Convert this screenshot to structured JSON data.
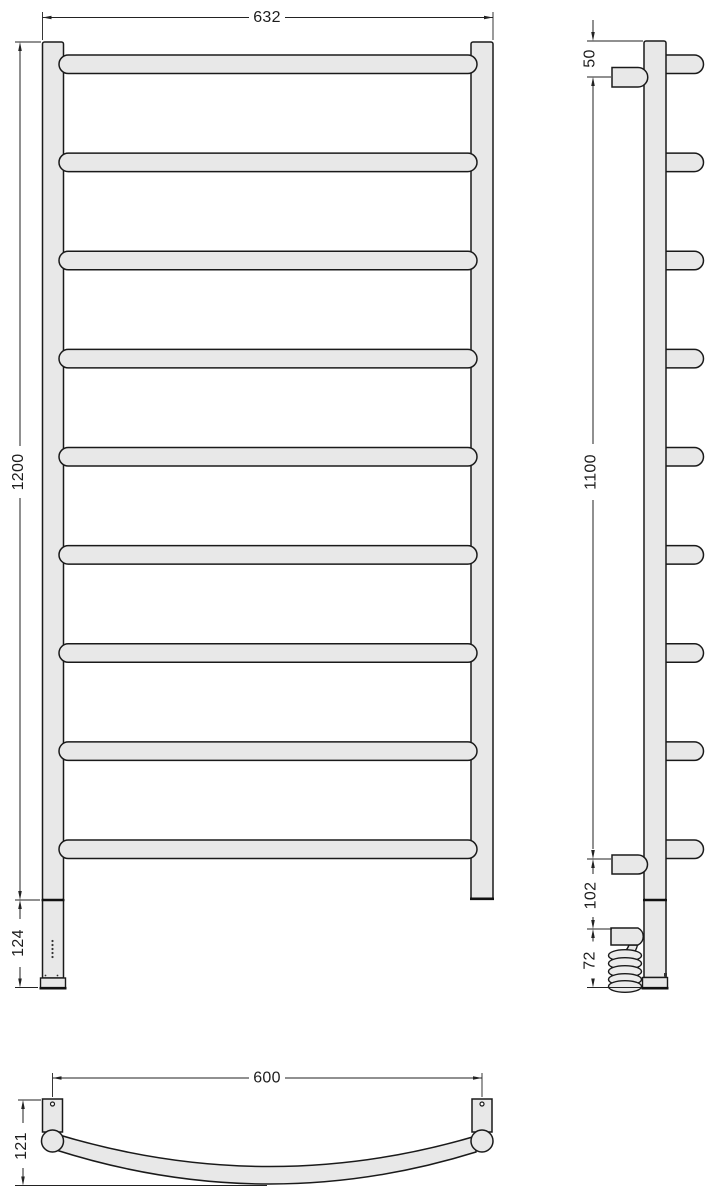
{
  "drawing_type": "technical-drawing-towel-rail",
  "views": {
    "front": {
      "label": "front-view",
      "bar_count": 9,
      "dimensions": {
        "width": {
          "value": "632"
        },
        "height": {
          "value": "1200"
        },
        "heater_section": {
          "value": "124"
        }
      }
    },
    "side": {
      "label": "side-view",
      "bar_count": 9,
      "bracket_count": 2,
      "dimensions": {
        "top_offset": {
          "value": "50"
        },
        "bracket_span": {
          "value": "1100"
        },
        "connection_offset": {
          "value": "102"
        },
        "cable_drop": {
          "value": "72"
        }
      }
    },
    "bottom": {
      "label": "bottom-view",
      "dimensions": {
        "rail_width": {
          "value": "600"
        },
        "depth": {
          "value": "121"
        }
      }
    }
  },
  "colors": {
    "background": "#ffffff",
    "body_fill": "#e8e8e8",
    "outline": "#1a1a1a",
    "dimension_lines": "#222222"
  }
}
